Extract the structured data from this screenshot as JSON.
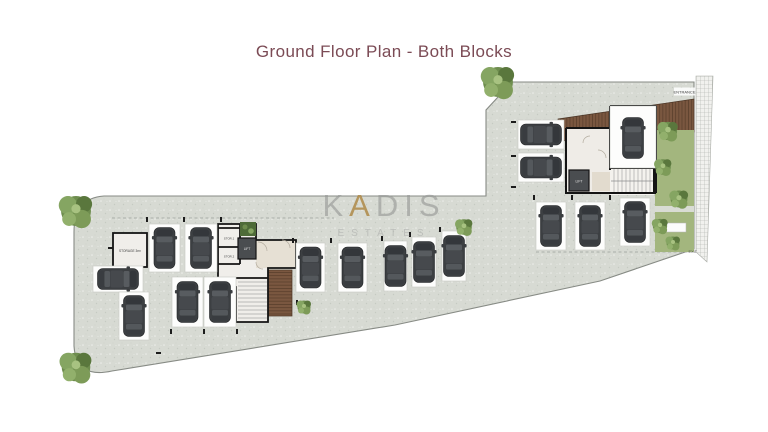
{
  "title": "Ground Floor Plan - Both Blocks",
  "watermark": {
    "brand_prefix": "K",
    "brand_accent": "A",
    "brand_suffix": "DIS",
    "sub": "ESTATES"
  },
  "labels": {
    "entrance": "ENTRANCE",
    "exit": "EXIT",
    "lift": "LIFT",
    "storage_room": "STORAGE 3m²",
    "storage_1": "STOR.1",
    "storage_2": "STOR.2"
  },
  "colors": {
    "title_text": "#7b4b55",
    "paving": "#d7dad3",
    "wall": "#141414",
    "deck_wood": "#7a5740",
    "garden_green": "#a3b67e",
    "tree_green": "#6e8d4e",
    "car_body": "#3c3f42",
    "watermark_gray": "#949694",
    "watermark_gold": "#b08d4f",
    "lift_fill": "#4a4d50"
  },
  "plan": {
    "parking_spots": [
      {
        "id": "L-A1",
        "pad": [
          149,
          224,
          31,
          48
        ],
        "car": [
          164.5,
          248,
          0
        ]
      },
      {
        "id": "L-A2",
        "pad": [
          185,
          224,
          32,
          48
        ],
        "car": [
          201,
          248,
          0
        ]
      },
      {
        "id": "L-B1",
        "pad": [
          93,
          266,
          50,
          26
        ],
        "car": [
          118,
          279,
          90
        ]
      },
      {
        "id": "L-B2",
        "pad": [
          119,
          292,
          30,
          48
        ],
        "car": [
          134,
          316,
          0
        ]
      },
      {
        "id": "L-C1",
        "pad": [
          172,
          277,
          31,
          50
        ],
        "car": [
          187.5,
          302,
          0
        ]
      },
      {
        "id": "L-C2",
        "pad": [
          204,
          277,
          32,
          50
        ],
        "car": [
          220,
          302,
          0
        ]
      },
      {
        "id": "L-D1",
        "pad": [
          296,
          243,
          29,
          49
        ],
        "car": [
          310.5,
          267.5,
          0
        ]
      },
      {
        "id": "L-D2",
        "pad": [
          338,
          243,
          29,
          49
        ],
        "car": [
          352.5,
          267.5,
          0
        ]
      },
      {
        "id": "M-E1",
        "pad": [
          384,
          241,
          23,
          50
        ],
        "car": [
          395.5,
          266,
          0
        ]
      },
      {
        "id": "M-E2",
        "pad": [
          412,
          237,
          24,
          50
        ],
        "car": [
          424,
          262,
          0
        ]
      },
      {
        "id": "M-E3",
        "pad": [
          442,
          231,
          24,
          50
        ],
        "car": [
          454,
          256,
          0
        ]
      },
      {
        "id": "R-P1",
        "pad": [
          518,
          120,
          46,
          29
        ],
        "car": [
          541,
          134.5,
          90
        ]
      },
      {
        "id": "R-P2",
        "pad": [
          518,
          153,
          46,
          29
        ],
        "car": [
          541,
          167.5,
          90
        ]
      },
      {
        "id": "R-G1",
        "pad": [
          610,
          106,
          46,
          62
        ],
        "car": [
          633,
          138,
          0
        ]
      },
      {
        "id": "R-S1",
        "pad": [
          536,
          202,
          30,
          48
        ],
        "car": [
          551,
          226,
          0
        ]
      },
      {
        "id": "R-S2",
        "pad": [
          575,
          202,
          30,
          48
        ],
        "car": [
          590,
          226,
          0
        ]
      },
      {
        "id": "R-S3",
        "pad": [
          620,
          198,
          30,
          48
        ],
        "car": [
          635,
          222,
          0
        ]
      }
    ],
    "trees": [
      [
        76,
        211,
        1.15
      ],
      [
        76,
        367,
        1.1
      ],
      [
        498,
        82,
        1.15
      ],
      [
        464,
        227,
        0.6
      ],
      [
        304,
        307,
        0.5
      ],
      [
        668,
        131,
        0.7
      ],
      [
        663,
        167,
        0.6
      ],
      [
        679,
        199,
        0.65
      ],
      [
        660,
        226,
        0.55
      ],
      [
        673,
        243,
        0.5
      ]
    ]
  }
}
